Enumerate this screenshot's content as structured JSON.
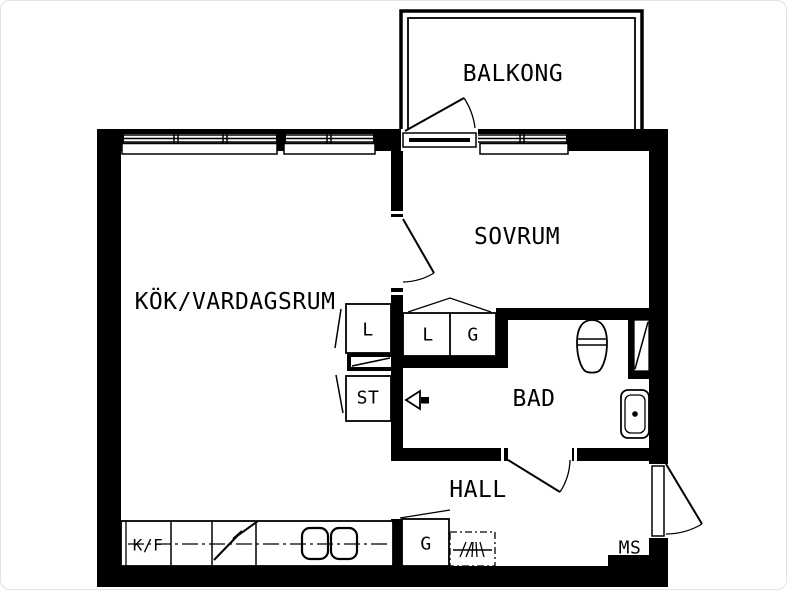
{
  "page": {
    "background": "#ffffff",
    "line_color": "#000000",
    "border_color": "#e2e2e2"
  },
  "labels": {
    "balcony": "BALKONG",
    "bedroom": "SOVRUM",
    "kitchen_living": "KÖK/VARDAGSRUM",
    "bathroom": "BAD",
    "hall": "HALL",
    "closet_linen_kitchen": "L",
    "closet_cleaning": "ST",
    "closet_linen_bath": "L",
    "closet_wardrobe_bath": "G",
    "fridge_freezer": "K/F",
    "closet_wardrobe_hall": "G",
    "meter_cabinet": "MS"
  },
  "fixtures": {
    "toilet": "toilet",
    "sink": "washbasin",
    "stove": "cooktop-two-burners",
    "coat_rack": "coat-rack",
    "shaft": "duct-shaft"
  }
}
